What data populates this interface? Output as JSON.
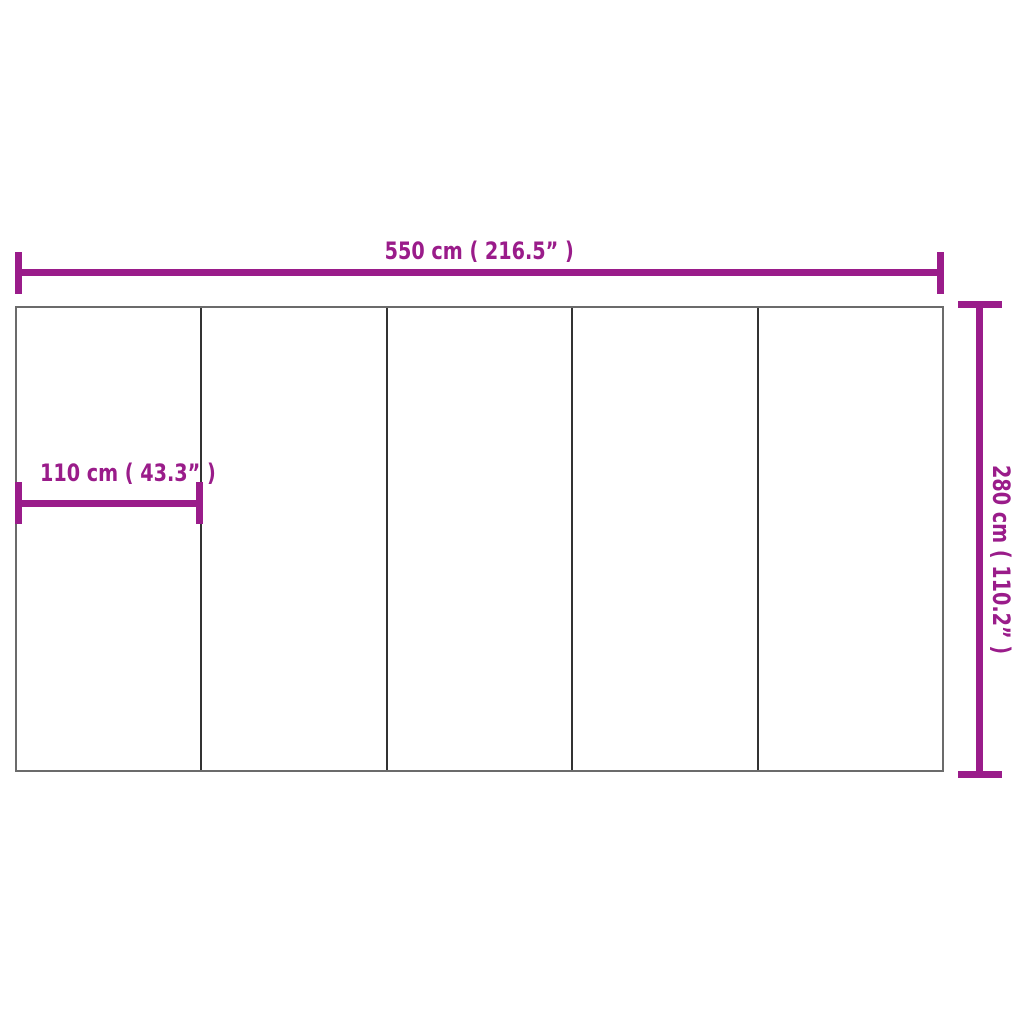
{
  "diagram": {
    "type": "product-dimension-diagram",
    "panel_count": 5,
    "colors": {
      "accent": "#9a1c8a",
      "outline": "#6b6b6b",
      "divider": "#333333",
      "background": "#ffffff"
    },
    "labels": {
      "overall_width": "550 cm ( 216.5”  )",
      "panel_width": "110 cm ( 43.3”  )",
      "overall_height": "280 cm ( 110.2”  )"
    }
  }
}
